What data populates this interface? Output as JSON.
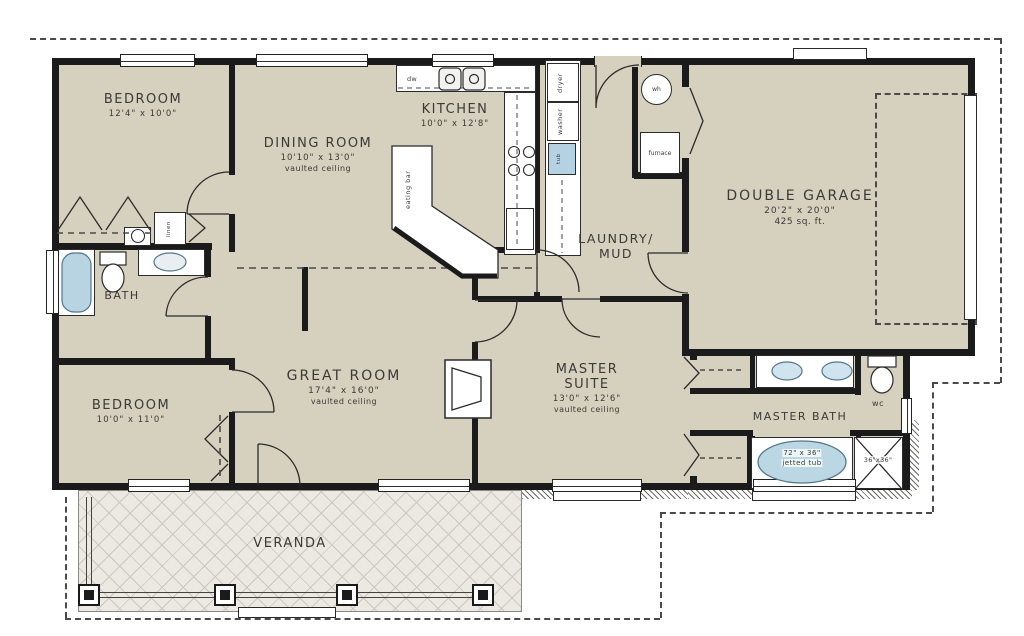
{
  "title": "single-storey house floor plan",
  "colors": {
    "floor": "#d6d0be",
    "wall": "#1b1b1b",
    "veranda_floor": "#ebe9e1",
    "hatch_line": "#c9c9c1",
    "water": "#b5d2e2",
    "ink": "#3a3a37",
    "paper": "#ffffff"
  },
  "rooms": {
    "bedroom1": {
      "name": "BEDROOM",
      "dims": "12'4\" x 10'0\""
    },
    "dining": {
      "name": "DINING ROOM",
      "dims": "10'10\" x 13'0\"",
      "note": "vaulted ceiling"
    },
    "kitchen": {
      "name": "KITCHEN",
      "dims": "10'0\" x 12'8\""
    },
    "laundry": {
      "line1": "LAUNDRY/",
      "line2": "MUD"
    },
    "garage": {
      "name": "DOUBLE GARAGE",
      "dims": "20'2\" x 20'0\"",
      "note": "425 sq. ft."
    },
    "bath": {
      "name": "BATH"
    },
    "bedroom2": {
      "name": "BEDROOM",
      "dims": "10'0\" x 11'0\""
    },
    "great": {
      "name": "GREAT ROOM",
      "dims": "17'4\" x 16'0\"",
      "note": "vaulted ceiling"
    },
    "master": {
      "line1": "MASTER",
      "line2": "SUITE",
      "dims": "13'0\" x 12'6\"",
      "note": "vaulted ceiling"
    },
    "masterbath": {
      "name": "MASTER BATH"
    },
    "wc": {
      "name": "wc"
    },
    "veranda": {
      "name": "VERANDA"
    }
  },
  "fixtures": {
    "dw": "dw",
    "washer": "washer",
    "dryer": "dryer",
    "tub": "tub",
    "wh": "wh",
    "furnace": "furnace",
    "linen": "linen",
    "eating_bar": "eating bar",
    "jetted_tub_size": "72\" x 36\"",
    "jetted_tub": "jetted tub",
    "shower_size": "36\"x36\""
  }
}
